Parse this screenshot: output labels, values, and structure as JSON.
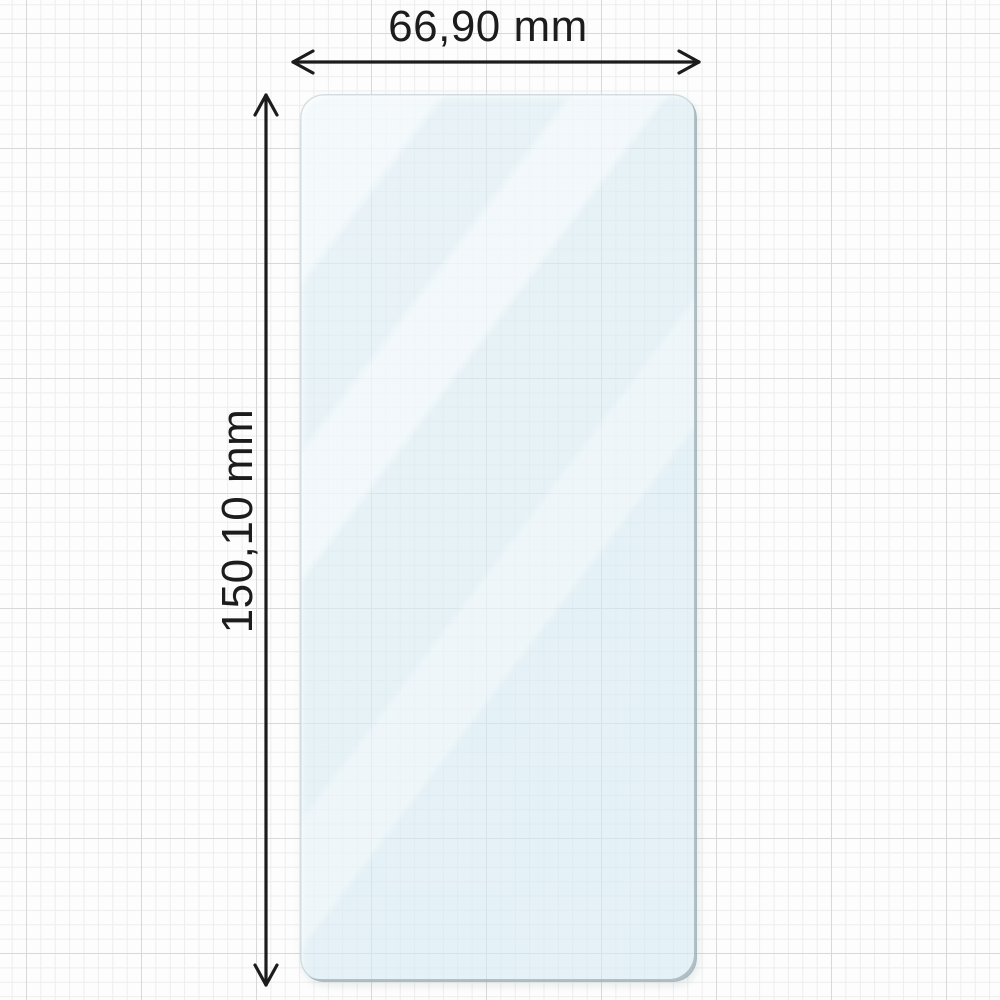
{
  "diagram": {
    "width_label": "66,90 mm",
    "height_label": "150,10 mm",
    "width_value_mm": 66.9,
    "height_value_mm": 150.1,
    "unit": "mm",
    "colors": {
      "text": "#1c1c1c",
      "arrow": "#1c1c1c",
      "paper": "#fdfdfd",
      "grid_minor": "#ededed",
      "grid_major": "#d8d8d8",
      "glass_tint": "rgba(214,234,242,0.62)",
      "glass_edge": "#8a989d"
    }
  }
}
